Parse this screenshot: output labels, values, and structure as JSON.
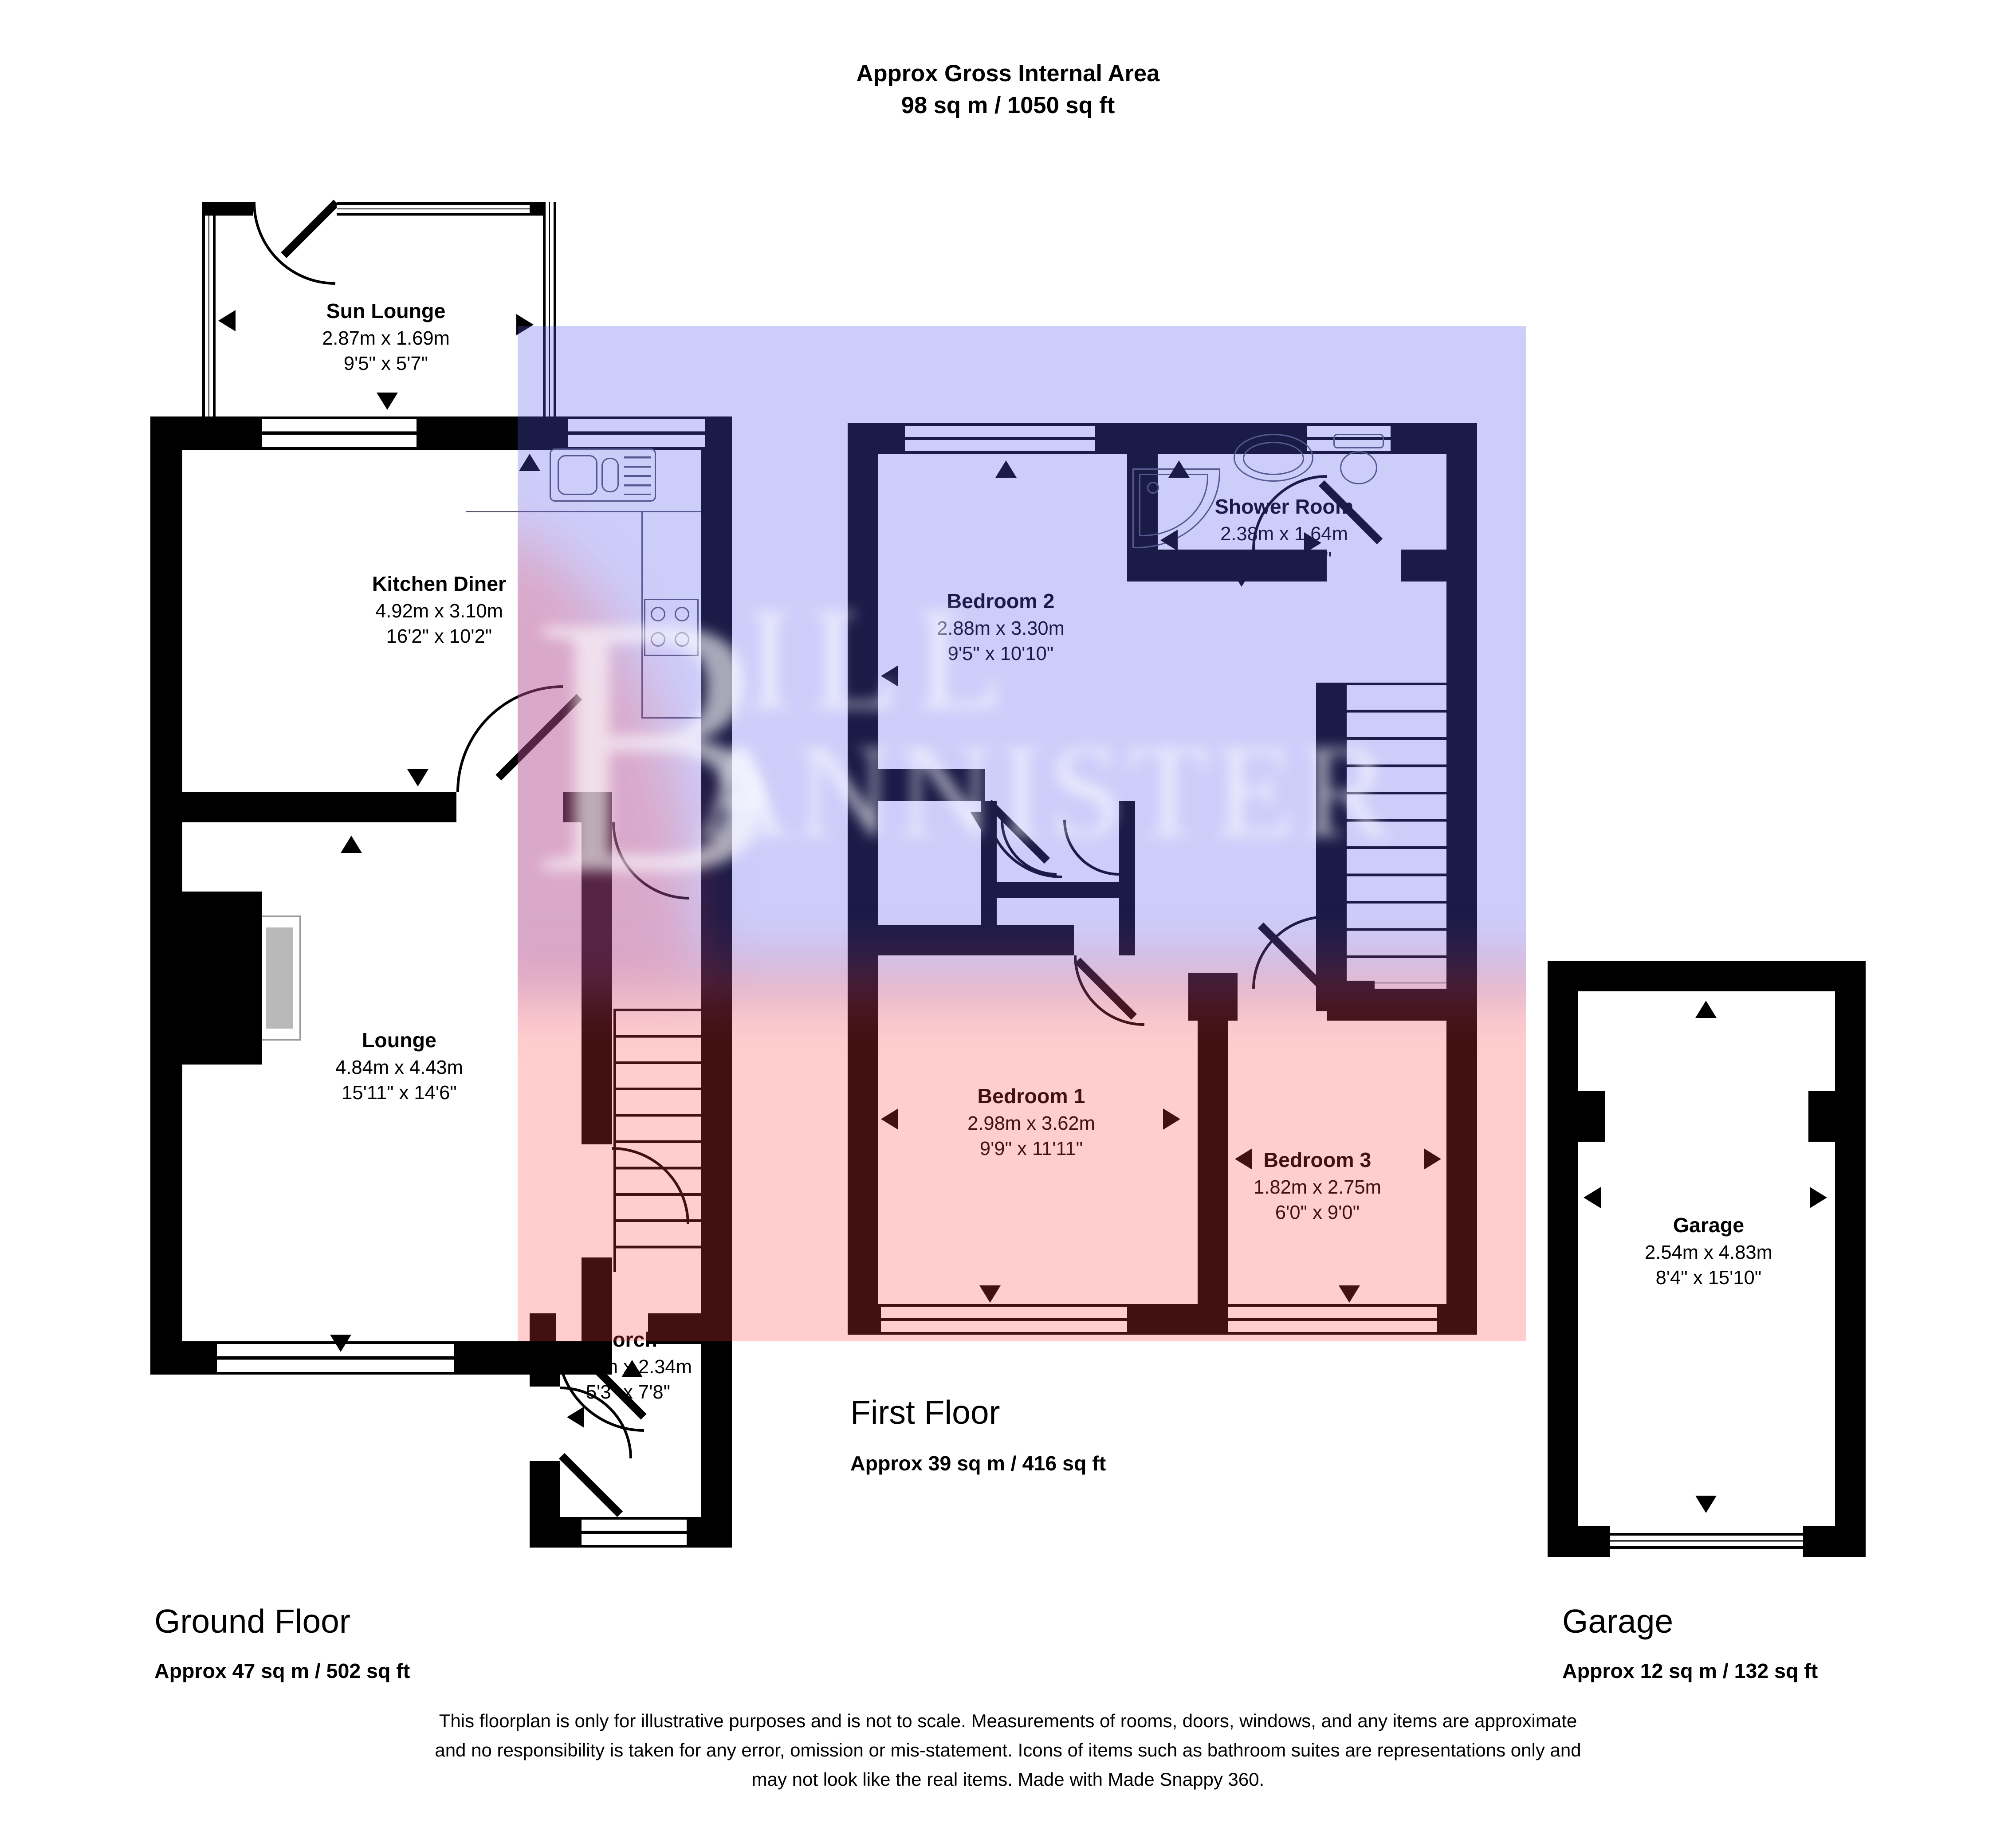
{
  "title": {
    "line1": "Approx Gross Internal Area",
    "line2": "98 sq m / 1050 sq ft"
  },
  "rooms": {
    "sun_lounge": {
      "name": "Sun Lounge",
      "metric": "2.87m x 1.69m",
      "imperial": "9'5\" x 5'7\""
    },
    "kitchen": {
      "name": "Kitchen Diner",
      "metric": "4.92m x 3.10m",
      "imperial": "16'2\" x 10'2\""
    },
    "lounge": {
      "name": "Lounge",
      "metric": "4.84m x 4.43m",
      "imperial": "15'11\" x 14'6\""
    },
    "porch": {
      "name": "Porch",
      "metric": "1.61m x 2.34m",
      "imperial": "5'3\" x 7'8\""
    },
    "bedroom2": {
      "name": "Bedroom 2",
      "metric": "2.88m x 3.30m",
      "imperial": "9'5\" x 10'10\""
    },
    "shower": {
      "name": "Shower Room",
      "metric": "2.38m x 1.64m",
      "imperial": "7'10\" x 5'5\""
    },
    "bedroom1": {
      "name": "Bedroom 1",
      "metric": "2.98m x 3.62m",
      "imperial": "9'9\" x 11'11\""
    },
    "bedroom3": {
      "name": "Bedroom 3",
      "metric": "1.82m x 2.75m",
      "imperial": "6'0\" x 9'0\""
    },
    "garage": {
      "name": "Garage",
      "metric": "2.54m x 4.83m",
      "imperial": "8'4\" x 15'10\""
    }
  },
  "floors": {
    "ground": {
      "label": "Ground Floor",
      "area": "Approx 47 sq m / 502 sq ft"
    },
    "first": {
      "label": "First Floor",
      "area": "Approx 39 sq m / 416 sq ft"
    },
    "garage": {
      "label": "Garage",
      "area": "Approx 12 sq m / 132 sq ft"
    }
  },
  "watermark": {
    "big": "B",
    "top": "ILL",
    "bottom": "ANNISTER"
  },
  "disclaimer": {
    "line1": "This floorplan is only for illustrative purposes and is not to scale. Measurements of rooms, doors, windows, and any items are approximate",
    "line2": "and no responsibility is taken for any error, omission or mis-statement. Icons of items such as bathroom suites are representations only and",
    "line3": "may not look like the real items. Made with Made Snappy 360."
  },
  "colors": {
    "wall": "#000000",
    "first_floor_wall_tinted": "#1a1a47",
    "ground_tinted_wall": "#42100f",
    "overlay_blue_bg": "#cdcdf8",
    "overlay_red_bg": "#ffcccc"
  }
}
